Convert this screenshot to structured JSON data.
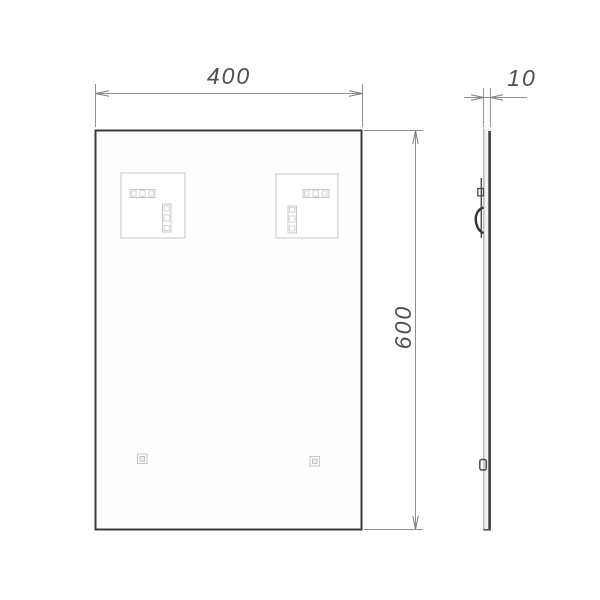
{
  "dimensions": {
    "width_label": "400",
    "height_label": "600",
    "thickness_label": "10"
  },
  "colors": {
    "background": "#ffffff",
    "outline": "#3a3a3a",
    "dimension_line": "#8f8f8f",
    "dimension_text": "#4f4f4f",
    "hidden_hardware": "#c7c7c7",
    "side_profile_edge": "#3f3f3f"
  }
}
